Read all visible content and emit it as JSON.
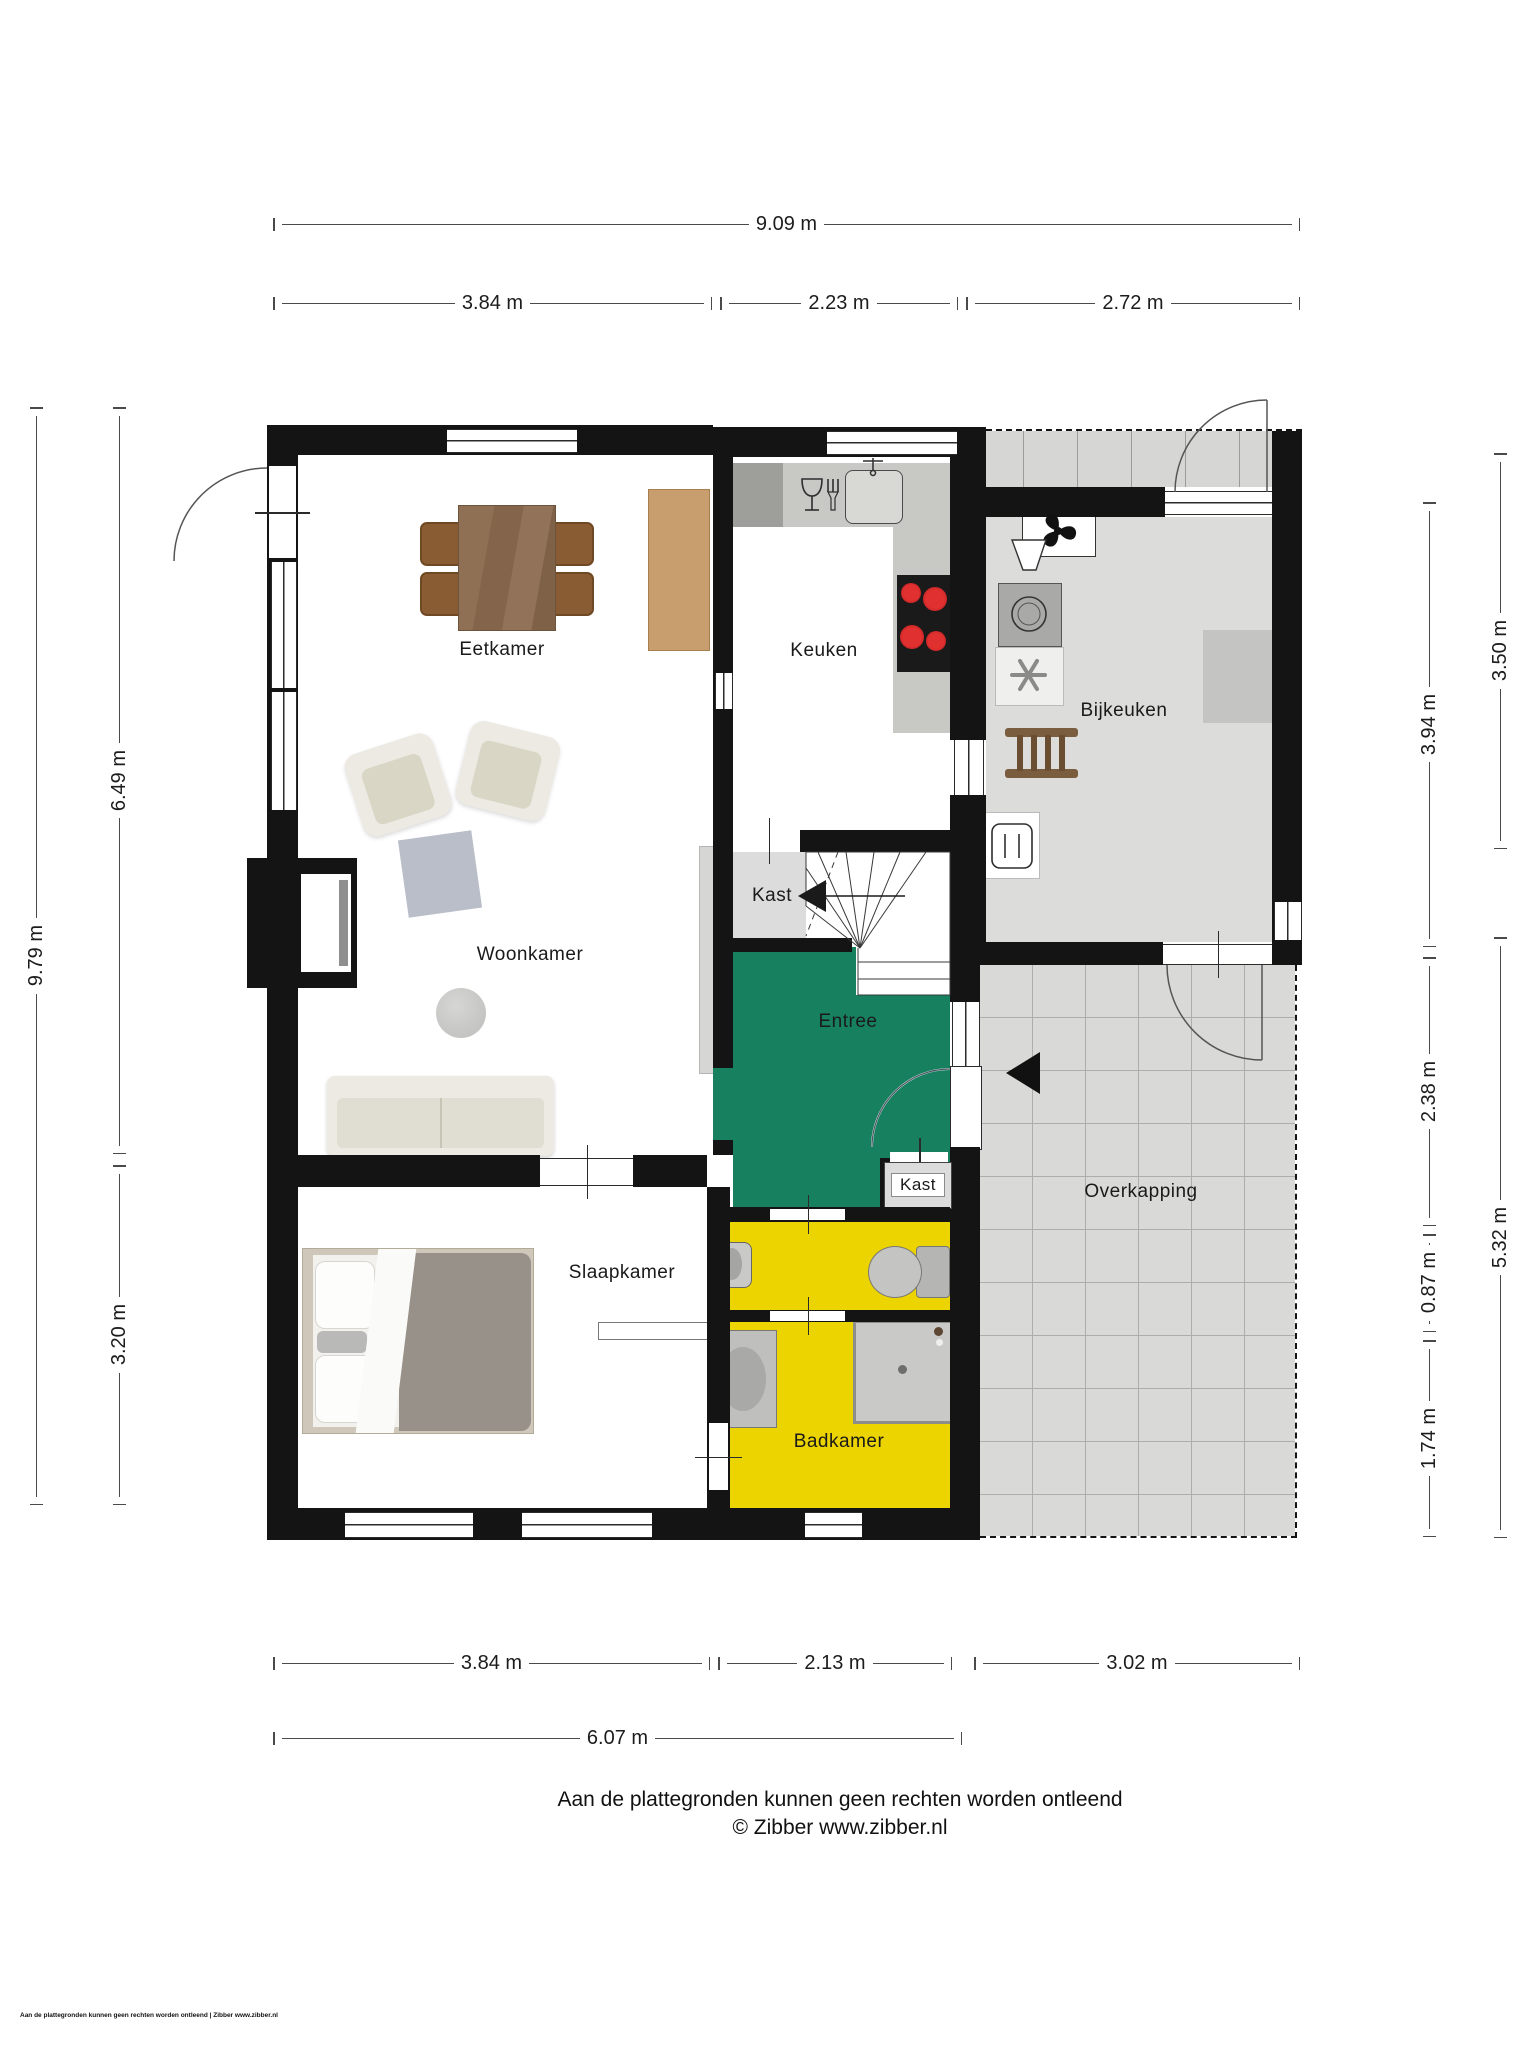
{
  "title": "Floor plan (begane grond)",
  "rooms": {
    "eetkamer": "Eetkamer",
    "keuken": "Keuken",
    "bijkeuken": "Bijkeuken",
    "kast_hal": "Kast",
    "woonkamer": "Woonkamer",
    "entree": "Entree",
    "kast_entree": "Kast",
    "slaapkamer": "Slaapkamer",
    "badkamer": "Badkamer",
    "overkapping": "Overkapping"
  },
  "dimensions": {
    "top": {
      "total": "9.09 m",
      "segments": [
        "3.84 m",
        "2.23 m",
        "2.72 m"
      ]
    },
    "bottom": {
      "segments": [
        "3.84 m",
        "2.13 m",
        "3.02 m"
      ],
      "total": "6.07 m"
    },
    "left": {
      "total": "9.79 m",
      "segments": [
        "6.49 m",
        "3.20 m"
      ]
    },
    "right": {
      "inner_segments": [
        "3.94 m",
        "2.38 m",
        "0.87 m",
        "1.74 m"
      ],
      "outer_segments": [
        "3.50 m",
        "5.32 m"
      ]
    }
  },
  "footer": {
    "disclaimer": "Aan de plattegronden kunnen geen rechten worden ontleend",
    "copyright": "© Zibber www.zibber.nl",
    "corner_note": "Aan de plattegronden kunnen geen rechten worden ontleend | Zibber www.zibber.nl"
  },
  "colors": {
    "wall": "#141414",
    "entree_floor": "#17805F",
    "bathroom_floor": "#ECD400",
    "bijkeuken_floor": "#DCDCDB",
    "overkapping_floor": "#D9D9D7",
    "stove_burner": "#CC2020",
    "dining_wood": "#8A6A50"
  }
}
